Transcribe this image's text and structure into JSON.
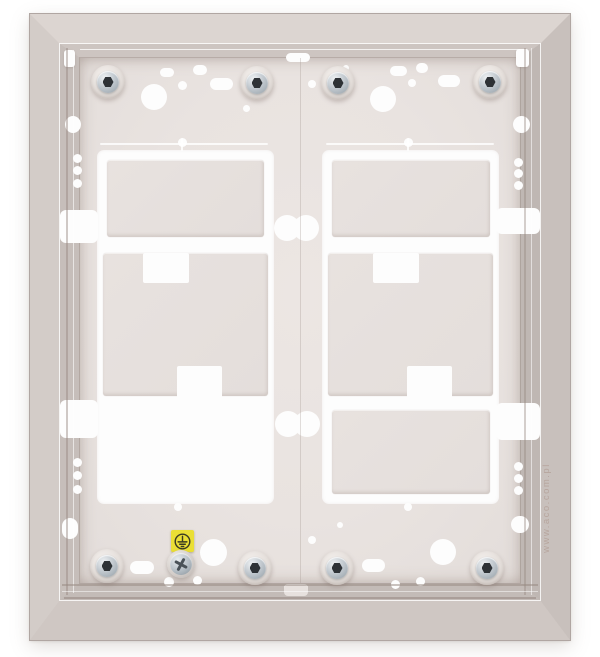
{
  "meta": {
    "subject": "Stainless-steel flush-mount back box for a modular door intercom, 2x2 module knockout windows, hex-socket mounting screws and earth-ground point",
    "watermark": "www.aco.com.pl"
  },
  "colors": {
    "background": "#ffffff",
    "bevel_top": "#dcd5d1",
    "bevel_left": "#d3ccc8",
    "bevel_right": "#c8c0bc",
    "bevel_bottom": "#cfc7c3",
    "frame_edge": "#b0a6a2",
    "wall_top": "#cdc5c1",
    "wall_left": "#c6beba",
    "wall_right": "#bfb7b3",
    "wall_bottom": "#c3bbb7",
    "panel": "#e9e3e0",
    "knockout_plate": "#e6e0dd",
    "cutout": "#fdfdfd",
    "screw_ring": "#b8c0c6",
    "screw_socket": "#2e3236",
    "ground_label_yellow": "#eadf35",
    "ground_symbol": "#3a3b22",
    "watermark_color": "#a98f85"
  },
  "frame": {
    "x": 30,
    "y": 14,
    "w": 540,
    "h": 626
  },
  "panel": {
    "x": 80,
    "y": 58,
    "w": 440,
    "h": 525
  },
  "watermark": {
    "x": 473,
    "y": 501,
    "w": 150,
    "h": 14
  },
  "columns": [
    {
      "x": 97,
      "y": 150,
      "w": 177,
      "h": 354,
      "plates": [
        {
          "x": 107,
          "y": 160,
          "w": 157,
          "h": 77
        },
        {
          "x": 103,
          "y": 253,
          "w": 165,
          "h": 143,
          "notches": [
            {
              "x": 143,
              "y": 253,
              "w": 46,
              "h": 30
            },
            {
              "x": 177,
              "y": 366,
              "w": 45,
              "h": 32
            }
          ]
        }
      ]
    },
    {
      "x": 322,
      "y": 150,
      "w": 177,
      "h": 354,
      "plates": [
        {
          "x": 332,
          "y": 160,
          "w": 158,
          "h": 77
        },
        {
          "x": 328,
          "y": 253,
          "w": 165,
          "h": 143,
          "notches": [
            {
              "x": 373,
              "y": 253,
              "w": 46,
              "h": 30
            },
            {
              "x": 407,
              "y": 366,
              "w": 45,
              "h": 32
            }
          ]
        },
        {
          "x": 332,
          "y": 410,
          "w": 158,
          "h": 84
        }
      ]
    }
  ],
  "slots": [
    {
      "x": 60,
      "y": 210,
      "w": 38,
      "h": 33
    },
    {
      "x": 60,
      "y": 400,
      "w": 38,
      "h": 38
    },
    {
      "x": 496,
      "y": 208,
      "w": 44,
      "h": 26
    },
    {
      "x": 496,
      "y": 403,
      "w": 44,
      "h": 37
    }
  ],
  "peanuts": [
    {
      "cx1": 287,
      "cx2": 306,
      "cy": 228,
      "d": 26
    },
    {
      "cx1": 288,
      "cx2": 307,
      "cy": 424,
      "d": 26
    }
  ],
  "holes": [
    {
      "shape": "circle",
      "x": 154,
      "y": 97,
      "w": 26,
      "h": 26
    },
    {
      "shape": "circle",
      "x": 383,
      "y": 99,
      "w": 26,
      "h": 26
    },
    {
      "shape": "circle",
      "x": 213,
      "y": 552,
      "w": 27,
      "h": 27
    },
    {
      "shape": "circle",
      "x": 443,
      "y": 552,
      "w": 26,
      "h": 26
    },
    {
      "shape": "circle",
      "x": 182,
      "y": 85,
      "w": 9,
      "h": 9
    },
    {
      "shape": "circle",
      "x": 312,
      "y": 84,
      "w": 8,
      "h": 8
    },
    {
      "shape": "circle",
      "x": 412,
      "y": 83,
      "w": 8,
      "h": 8
    },
    {
      "shape": "circle",
      "x": 246,
      "y": 108,
      "w": 7,
      "h": 7
    },
    {
      "shape": "circle",
      "x": 346,
      "y": 68,
      "w": 6,
      "h": 6
    },
    {
      "shape": "circle",
      "x": 182,
      "y": 142,
      "w": 9,
      "h": 9
    },
    {
      "shape": "circle",
      "x": 408,
      "y": 142,
      "w": 9,
      "h": 9
    },
    {
      "shape": "circle",
      "x": 178,
      "y": 507,
      "w": 8,
      "h": 8
    },
    {
      "shape": "circle",
      "x": 408,
      "y": 507,
      "w": 8,
      "h": 8
    },
    {
      "shape": "circle",
      "x": 73,
      "y": 124,
      "w": 16,
      "h": 17
    },
    {
      "shape": "circle",
      "x": 77,
      "y": 158,
      "w": 9,
      "h": 9
    },
    {
      "shape": "circle",
      "x": 77,
      "y": 170,
      "w": 9,
      "h": 9
    },
    {
      "shape": "circle",
      "x": 77,
      "y": 183,
      "w": 9,
      "h": 9
    },
    {
      "shape": "circle",
      "x": 77,
      "y": 462,
      "w": 9,
      "h": 9
    },
    {
      "shape": "circle",
      "x": 77,
      "y": 475,
      "w": 9,
      "h": 9
    },
    {
      "shape": "circle",
      "x": 77,
      "y": 489,
      "w": 9,
      "h": 9
    },
    {
      "shape": "circle",
      "x": 518,
      "y": 162,
      "w": 9,
      "h": 9
    },
    {
      "shape": "circle",
      "x": 518,
      "y": 173,
      "w": 9,
      "h": 9
    },
    {
      "shape": "circle",
      "x": 518,
      "y": 185,
      "w": 9,
      "h": 9
    },
    {
      "shape": "circle",
      "x": 518,
      "y": 466,
      "w": 9,
      "h": 9
    },
    {
      "shape": "circle",
      "x": 518,
      "y": 478,
      "w": 9,
      "h": 9
    },
    {
      "shape": "circle",
      "x": 518,
      "y": 490,
      "w": 9,
      "h": 9
    },
    {
      "shape": "circle",
      "x": 169,
      "y": 582,
      "w": 10,
      "h": 10
    },
    {
      "shape": "circle",
      "x": 197,
      "y": 580,
      "w": 9,
      "h": 9
    },
    {
      "shape": "circle",
      "x": 395,
      "y": 584,
      "w": 9,
      "h": 9
    },
    {
      "shape": "circle",
      "x": 420,
      "y": 581,
      "w": 9,
      "h": 9
    },
    {
      "shape": "circle",
      "x": 312,
      "y": 540,
      "w": 8,
      "h": 8
    },
    {
      "shape": "circle",
      "x": 340,
      "y": 525,
      "w": 6,
      "h": 6
    },
    {
      "shape": "oval",
      "x": 221,
      "y": 84,
      "w": 23,
      "h": 12
    },
    {
      "shape": "oval",
      "x": 449,
      "y": 81,
      "w": 22,
      "h": 12
    },
    {
      "shape": "oval",
      "x": 167,
      "y": 72,
      "w": 14,
      "h": 9
    },
    {
      "shape": "oval",
      "x": 200,
      "y": 70,
      "w": 14,
      "h": 10
    },
    {
      "shape": "oval",
      "x": 398,
      "y": 71,
      "w": 17,
      "h": 10
    },
    {
      "shape": "oval",
      "x": 422,
      "y": 68,
      "w": 12,
      "h": 10
    },
    {
      "shape": "oval",
      "x": 298,
      "y": 57,
      "w": 24,
      "h": 9
    },
    {
      "shape": "oval",
      "x": 373,
      "y": 565,
      "w": 23,
      "h": 13
    },
    {
      "shape": "oval",
      "x": 142,
      "y": 567,
      "w": 24,
      "h": 13
    },
    {
      "shape": "oval",
      "x": 70,
      "y": 528,
      "w": 16,
      "h": 21
    },
    {
      "shape": "oval",
      "x": 521,
      "y": 124,
      "w": 17,
      "h": 17
    },
    {
      "shape": "oval",
      "x": 520,
      "y": 524,
      "w": 18,
      "h": 17
    }
  ],
  "scribes": [
    {
      "x": 100,
      "y": 143,
      "w": 168,
      "h": 2
    },
    {
      "x": 326,
      "y": 143,
      "w": 168,
      "h": 2
    },
    {
      "x": 181,
      "y": 138,
      "w": 2,
      "h": 13
    },
    {
      "x": 407,
      "y": 138,
      "w": 2,
      "h": 13
    }
  ],
  "clips": [
    {
      "x": 64,
      "y": 50,
      "w": 11,
      "h": 17
    },
    {
      "x": 516,
      "y": 49,
      "w": 13,
      "h": 18
    }
  ],
  "panel_tabs": [
    {
      "x": 284,
      "y": 584,
      "w": 24,
      "h": 12
    }
  ],
  "lines": [
    {
      "x": 80,
      "y": 49,
      "w": 440,
      "h": 1,
      "c": "rgba(255,255,255,0.75)"
    },
    {
      "x": 66,
      "y": 48,
      "w": 2,
      "h": 547,
      "c": "rgba(150,135,128,0.45)"
    },
    {
      "x": 73,
      "y": 50,
      "w": 1,
      "h": 543,
      "c": "rgba(255,255,255,0.60)"
    },
    {
      "x": 524,
      "y": 48,
      "w": 2,
      "h": 547,
      "c": "rgba(150,135,128,0.40)"
    },
    {
      "x": 531,
      "y": 48,
      "w": 1,
      "h": 547,
      "c": "rgba(255,255,255,0.55)"
    },
    {
      "x": 62,
      "y": 584,
      "w": 476,
      "h": 2,
      "c": "rgba(150,135,128,0.50)"
    },
    {
      "x": 62,
      "y": 591,
      "w": 476,
      "h": 1,
      "c": "rgba(255,255,255,0.50)"
    },
    {
      "x": 64,
      "y": 597,
      "w": 472,
      "h": 2,
      "c": "rgba(140,125,118,0.45)"
    },
    {
      "x": 300,
      "y": 58,
      "w": 1,
      "h": 525,
      "c": "rgba(160,145,138,0.30)"
    }
  ],
  "screw_geom": {
    "flange": 34,
    "ring": 22,
    "socket": 11
  },
  "screws": [
    {
      "x": 108,
      "y": 82
    },
    {
      "x": 257,
      "y": 83
    },
    {
      "x": 338,
      "y": 83
    },
    {
      "x": 490,
      "y": 82
    },
    {
      "x": 107,
      "y": 566
    },
    {
      "x": 255,
      "y": 568
    },
    {
      "x": 337,
      "y": 568
    },
    {
      "x": 487,
      "y": 568
    }
  ],
  "ground": {
    "label": {
      "x": 171,
      "y": 530,
      "w": 23,
      "h": 22
    },
    "flange": {
      "x": 167,
      "y": 550,
      "w": 28,
      "h": 28
    }
  }
}
